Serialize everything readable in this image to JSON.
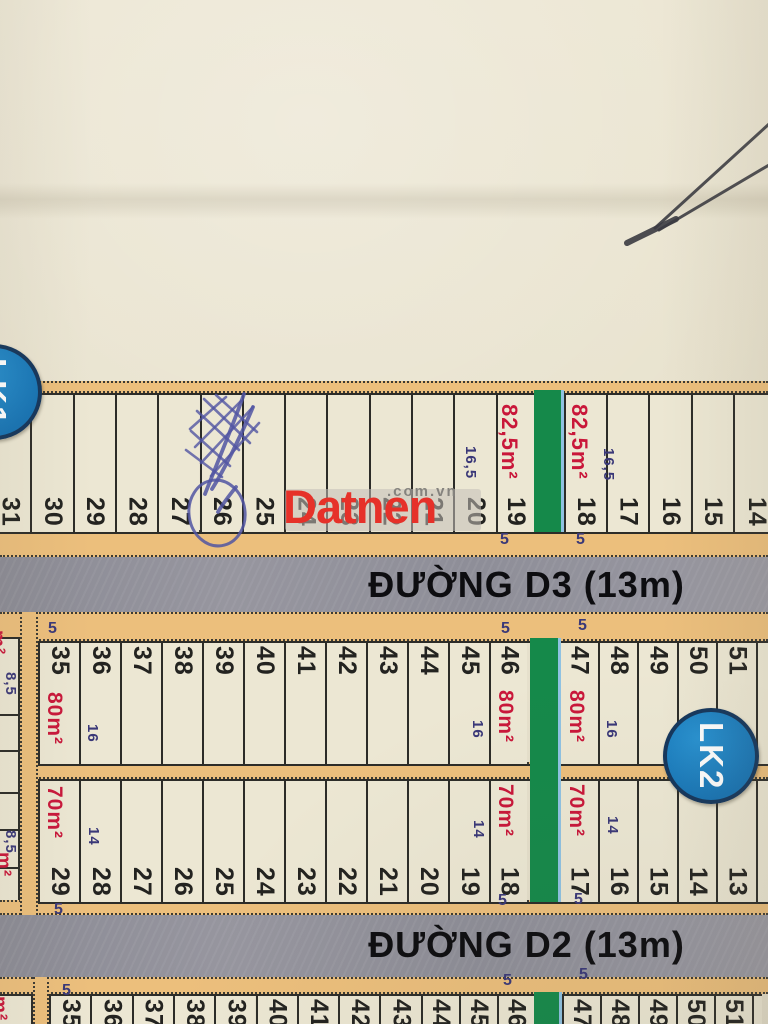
{
  "watermark": {
    "brand": "Datnen",
    "suffix": ".com.vn"
  },
  "badges": [
    {
      "label": "LK1"
    },
    {
      "label": "LK2"
    }
  ],
  "roads": [
    {
      "label": "ĐƯỜNG D3 (13m)"
    },
    {
      "label": "ĐƯỜNG D2 (13m)"
    }
  ],
  "colors": {
    "paper": "#e8e2cd",
    "cell": "#ece7d3",
    "orange": "#ecbf7c",
    "road_gray": "#90909a",
    "green": "#15894a",
    "area_red": "#c9173a",
    "dim_navy": "#3a3878",
    "number_ink": "#232320",
    "badge_blue": "#1a7cc0",
    "badge_border": "#14365c",
    "wm_red": "#e63129",
    "wm_gray": "#85837e",
    "pen_blue": "#5155a2",
    "photo_line_gray": "#3b3b41"
  },
  "map": {
    "rows": [
      {
        "id": "lk1-facing-d3",
        "numbers_at": "bottom",
        "y": 393,
        "h": 137,
        "x0": -12,
        "cw": 42.3,
        "cells": [
          {
            "n": "31"
          },
          {
            "n": "30"
          },
          {
            "n": "29"
          },
          {
            "n": "28"
          },
          {
            "n": "27"
          },
          {
            "n": "26"
          },
          {
            "n": "25"
          },
          {
            "n": "24"
          },
          {
            "n": "23"
          },
          {
            "n": "22"
          },
          {
            "n": "21"
          },
          {
            "n": "20"
          },
          {
            "n": "19",
            "w": 38
          },
          {
            "green": true,
            "w": 30
          },
          {
            "n": "18"
          },
          {
            "n": "17"
          },
          {
            "n": "16"
          },
          {
            "n": "15"
          },
          {
            "n": "14",
            "w": 45
          }
        ]
      },
      {
        "id": "lk2-facing-d3",
        "numbers_at": "top",
        "y": 641,
        "h": 121,
        "x0": 38,
        "cw": 41,
        "cells": [
          {
            "n": "35"
          },
          {
            "n": "36"
          },
          {
            "n": "37"
          },
          {
            "n": "38"
          },
          {
            "n": "39"
          },
          {
            "n": "40"
          },
          {
            "n": "41"
          },
          {
            "n": "42"
          },
          {
            "n": "43"
          },
          {
            "n": "44"
          },
          {
            "n": "45"
          },
          {
            "n": "46",
            "w": 38
          },
          {
            "green": true,
            "w": 31
          },
          {
            "n": "47",
            "w": 39.5
          },
          {
            "n": "48",
            "w": 39.5
          },
          {
            "n": "49",
            "w": 39.5
          },
          {
            "n": "50",
            "w": 39.5
          },
          {
            "n": "51",
            "w": 39.5
          },
          {
            "n": "",
            "w": 12
          }
        ]
      },
      {
        "id": "lk2-facing-d2",
        "numbers_at": "bottom",
        "y": 779,
        "h": 121,
        "x0": 38,
        "cw": 41,
        "cells": [
          {
            "n": "29"
          },
          {
            "n": "28"
          },
          {
            "n": "27"
          },
          {
            "n": "26"
          },
          {
            "n": "25"
          },
          {
            "n": "24"
          },
          {
            "n": "23"
          },
          {
            "n": "22"
          },
          {
            "n": "21"
          },
          {
            "n": "20"
          },
          {
            "n": "19"
          },
          {
            "n": "18",
            "w": 38
          },
          {
            "green": true,
            "w": 31
          },
          {
            "n": "17",
            "w": 39.5
          },
          {
            "n": "16",
            "w": 39.5
          },
          {
            "n": "15",
            "w": 39.5
          },
          {
            "n": "14",
            "w": 39.5
          },
          {
            "n": "13",
            "w": 39.5
          },
          {
            "n": "",
            "w": 12
          }
        ]
      },
      {
        "id": "lk3-facing-d2",
        "numbers_at": "top",
        "y": 994,
        "h": 30,
        "x0": 49,
        "cw": 41.3,
        "cells": [
          {
            "n": "35"
          },
          {
            "n": "36"
          },
          {
            "n": "37"
          },
          {
            "n": "38"
          },
          {
            "n": "39"
          },
          {
            "n": "40"
          },
          {
            "n": "41"
          },
          {
            "n": "42"
          },
          {
            "n": "43"
          },
          {
            "n": "44",
            "w": 38
          },
          {
            "n": "45",
            "w": 38
          },
          {
            "n": "46",
            "w": 37
          },
          {
            "green": true,
            "w": 28
          },
          {
            "n": "47",
            "w": 38
          },
          {
            "n": "48",
            "w": 38
          },
          {
            "n": "49",
            "w": 38
          },
          {
            "n": "50",
            "w": 38
          },
          {
            "n": "51",
            "w": 38
          },
          {
            "n": "",
            "w": 10
          }
        ]
      }
    ],
    "green_strips": [
      {
        "x": 533.6,
        "y": 390,
        "w": 30,
        "h": 142
      },
      {
        "x": 530,
        "y": 638,
        "w": 31,
        "h": 264
      },
      {
        "x": 533.7,
        "y": 992,
        "w": 28,
        "h": 32
      }
    ],
    "sidewalks": [
      {
        "x": 0,
        "y": 381,
        "w": 768,
        "h": 12
      },
      {
        "x": 0,
        "y": 530,
        "w": 768,
        "h": 27
      },
      {
        "x": 0,
        "y": 612,
        "w": 768,
        "h": 29
      },
      {
        "x": 20,
        "y": 762,
        "w": 748,
        "h": 17
      },
      {
        "x": 0,
        "y": 900,
        "w": 768,
        "h": 15
      },
      {
        "x": 0,
        "y": 977,
        "w": 768,
        "h": 17
      }
    ],
    "side_strips": [
      {
        "x": 20,
        "y": 612,
        "w": 18,
        "h": 303
      },
      {
        "x": 33,
        "y": 977,
        "w": 16,
        "h": 47
      }
    ],
    "edge_blocks": [
      {
        "x": 0,
        "y": 637,
        "w": 20,
        "h": 263,
        "dividers": [
          75,
          111,
          153,
          190,
          228
        ]
      },
      {
        "x": 0,
        "y": 994,
        "w": 33,
        "h": 30,
        "dividers": []
      }
    ],
    "area_labels": [
      {
        "text": "82,5m²",
        "x": 496,
        "y": 404,
        "fs": 22
      },
      {
        "text": "82,5m²",
        "x": 566,
        "y": 404,
        "fs": 22
      },
      {
        "text": "80m²",
        "x": 42,
        "y": 692,
        "fs": 21
      },
      {
        "text": "80m²",
        "x": 493,
        "y": 690,
        "fs": 21
      },
      {
        "text": "80m²",
        "x": 564,
        "y": 690,
        "fs": 21
      },
      {
        "text": "70m²",
        "x": 42,
        "y": 786,
        "fs": 21
      },
      {
        "text": "70m²",
        "x": 493,
        "y": 784,
        "fs": 21
      },
      {
        "text": "70m²",
        "x": 564,
        "y": 784,
        "fs": 21
      },
      {
        "text": "m²",
        "x": -14,
        "y": 630,
        "fs": 19
      },
      {
        "text": "m²",
        "x": -8,
        "y": 852,
        "fs": 19
      },
      {
        "text": "m²",
        "x": -12,
        "y": 996,
        "fs": 19
      }
    ],
    "dim_labels": [
      {
        "text": "16,5",
        "x": 462,
        "y": 446
      },
      {
        "text": "16,5",
        "x": 600,
        "y": 448
      },
      {
        "text": "16",
        "x": 84,
        "y": 724
      },
      {
        "text": "16",
        "x": 469,
        "y": 720
      },
      {
        "text": "16",
        "x": 603,
        "y": 720
      },
      {
        "text": "14",
        "x": 85,
        "y": 827
      },
      {
        "text": "14",
        "x": 470,
        "y": 820
      },
      {
        "text": "14",
        "x": 604,
        "y": 816
      },
      {
        "text": "8,5",
        "x": 2,
        "y": 672
      },
      {
        "text": "8,5",
        "x": 2,
        "y": 830
      }
    ],
    "width_labels": [
      {
        "text": "5",
        "x": 500,
        "y": 531
      },
      {
        "text": "5",
        "x": 576,
        "y": 531
      },
      {
        "text": "5",
        "x": 48,
        "y": 620
      },
      {
        "text": "5",
        "x": 501,
        "y": 620
      },
      {
        "text": "5",
        "x": 578,
        "y": 617
      },
      {
        "text": "5",
        "x": 54,
        "y": 901
      },
      {
        "text": "5",
        "x": 498,
        "y": 892
      },
      {
        "text": "5",
        "x": 574,
        "y": 891
      },
      {
        "text": "5",
        "x": 62,
        "y": 982
      },
      {
        "text": "5",
        "x": 503,
        "y": 972
      },
      {
        "text": "5",
        "x": 579,
        "y": 966
      }
    ]
  },
  "annotations": {
    "pen": {
      "hatch_paths": [
        "M197,411 L239,450",
        "M204,399 L250,443",
        "M216,395 L257,432",
        "M191,431 L230,466",
        "M186,450 L222,477",
        "M195,447 L241,401",
        "M201,463 L253,407",
        "M211,476 L259,423",
        "M190,429 L226,397"
      ],
      "stroke_paths": [
        "M244,394 C232,428 216,466 205,494",
        "M253,407 C240,438 224,470 212,489",
        "M236,487 C228,497 222,505 218,512"
      ],
      "circle": {
        "cx": 217,
        "cy": 513,
        "rx": 28,
        "ry": 33
      }
    },
    "photo_lines": [
      {
        "d": "M769,124 L655,228",
        "w": 3
      },
      {
        "d": "M769,165 L659,230",
        "w": 3
      },
      {
        "d": "M676,219 L627,243",
        "w": 6
      }
    ]
  }
}
